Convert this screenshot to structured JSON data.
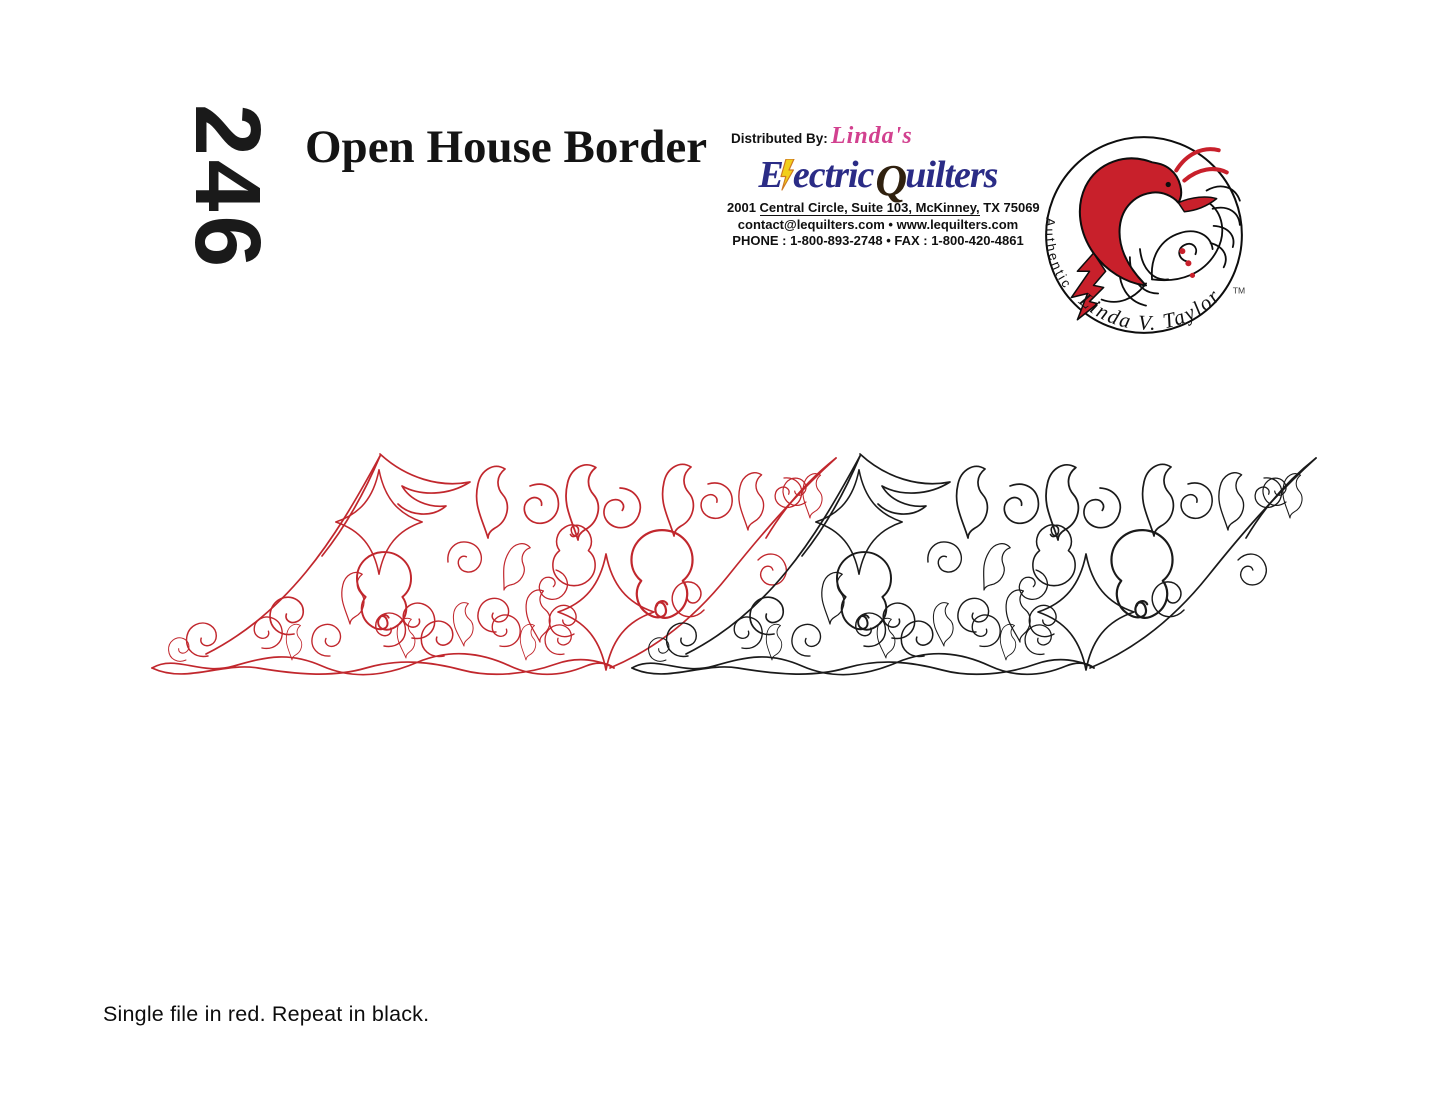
{
  "pattern_number": "246",
  "title": "Open House Border",
  "caption": "Single file in red. Repeat in black.",
  "distributor": {
    "label": "Distributed By:",
    "brand_script": "Linda's",
    "brand": {
      "electric_initial": "E",
      "electric_rest": "ectric",
      "quilters_initial": "Q",
      "quilters_rest": "uilters"
    },
    "address": {
      "pre": "2001 ",
      "underlined": "Central Circle, Suite 103, McKinney,",
      "post": " TX 75069"
    },
    "contact_line": "contact@lequilters.com • www.lequilters.com",
    "phone_line": "PHONE : 1-800-893-2748 • FAX : 1-800-420-4861"
  },
  "logo": {
    "arc_label": "Authentic",
    "arc_name": "Linda V. Taylor",
    "trademark": "TM"
  },
  "pattern": {
    "single_color": "#c1272d",
    "repeat_color": "#1a1a1a"
  }
}
